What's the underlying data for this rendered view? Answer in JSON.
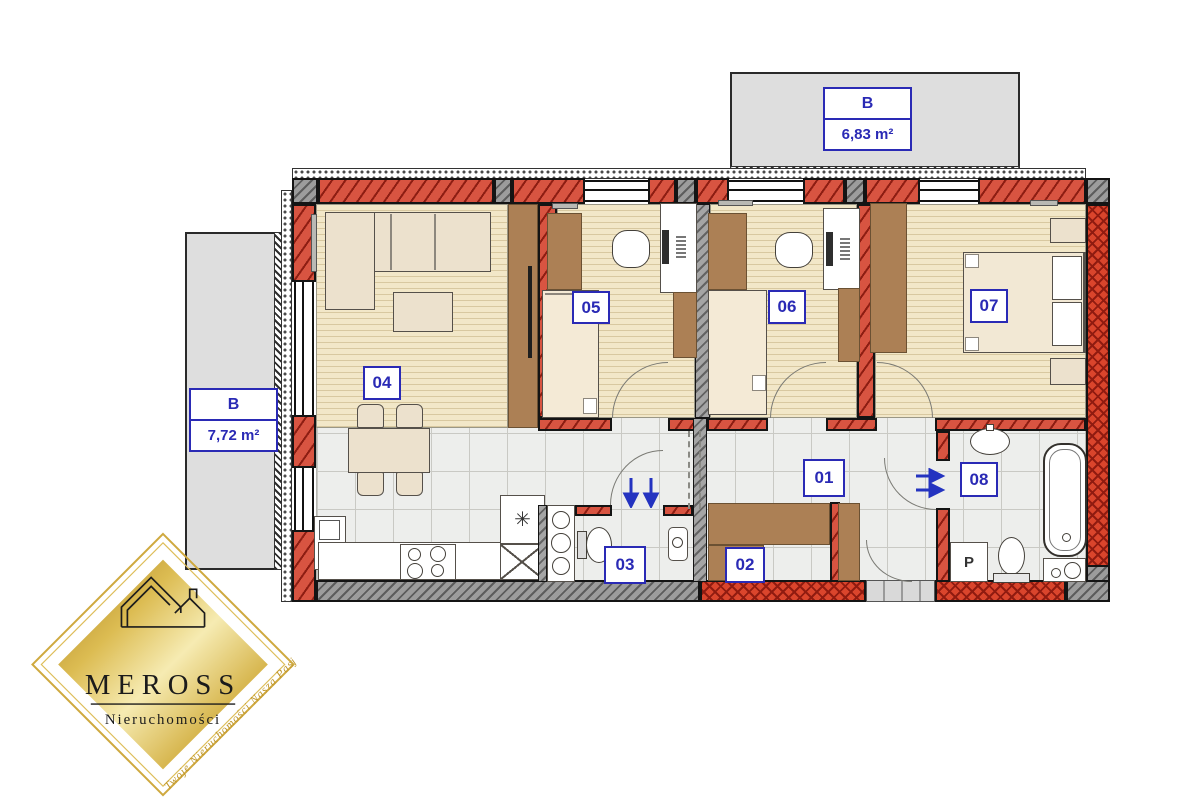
{
  "floorplan": {
    "room_labels": {
      "r01": "01",
      "r02": "02",
      "r03": "03",
      "r04": "04",
      "r05": "05",
      "r06": "06",
      "r07": "07",
      "r08": "08"
    },
    "balconies": {
      "top": {
        "label": "B",
        "area": "6,83 m²"
      },
      "left": {
        "label": "B",
        "area": "7,72 m²"
      }
    },
    "appliance_labels": {
      "washing_machine": "P"
    },
    "symbols": {
      "kitchen_sink": "✳"
    },
    "colors": {
      "wall_brick_red": "#d85441",
      "hatch_dark_red": "#8d1d12",
      "concrete_gray": "#9c9c9c",
      "wood_floor": "#f2e7c8",
      "tile_floor": "#edeeec",
      "furniture_brown": "#ac8055",
      "furniture_beige": "#ece1cd",
      "balcony_gray": "#dedede",
      "label_blue": "#2a2ab5",
      "arrow_blue": "#2433c0",
      "logo_gold": "#c9a23b"
    }
  },
  "logo": {
    "brand": "MEROSS",
    "subtitle": "Nieruchomości",
    "tagline": "Twoje Nieruchomości Nasza Pasja"
  }
}
